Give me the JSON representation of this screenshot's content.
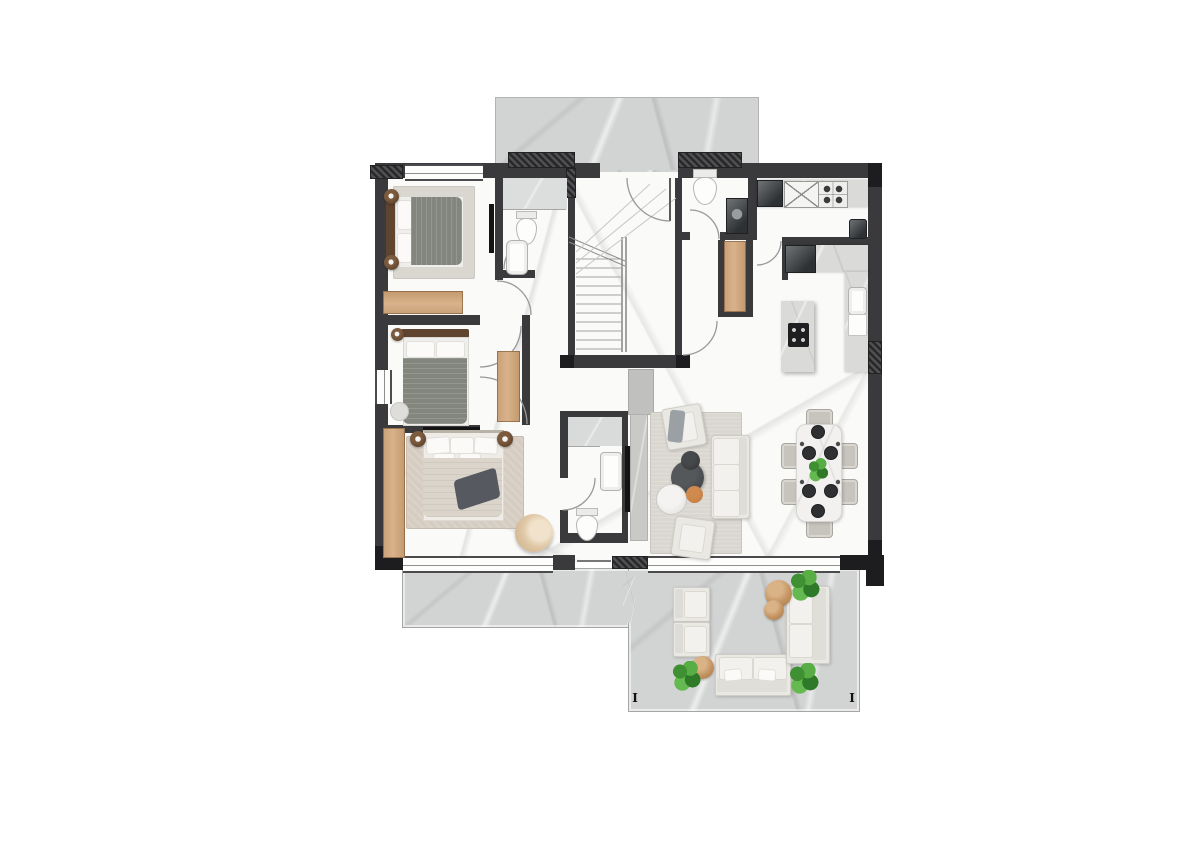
{
  "floorplan": {
    "section_markers": {
      "left_label": "I",
      "right_label": "I"
    },
    "colors": {
      "wall": "#3a3a3c",
      "wall-dark": "#1d1d1f",
      "floor": "#fafaf9",
      "marble": "#d2d3d3",
      "wood": "#c9a078",
      "sofa": "#eae8e3",
      "chair": "#c7c4bd",
      "rug": "#dad7d1",
      "rug-warm": "#d6cdc2",
      "blanket-green": "#83867d",
      "blanket-beige": "#dbd4ca",
      "throw-dark": "#565a60",
      "headboard": "#5f4430",
      "accent-orange": "#c0763c",
      "plant-green": "#479539",
      "tv": "#141414",
      "marble-white": "#f2f1ef"
    }
  }
}
